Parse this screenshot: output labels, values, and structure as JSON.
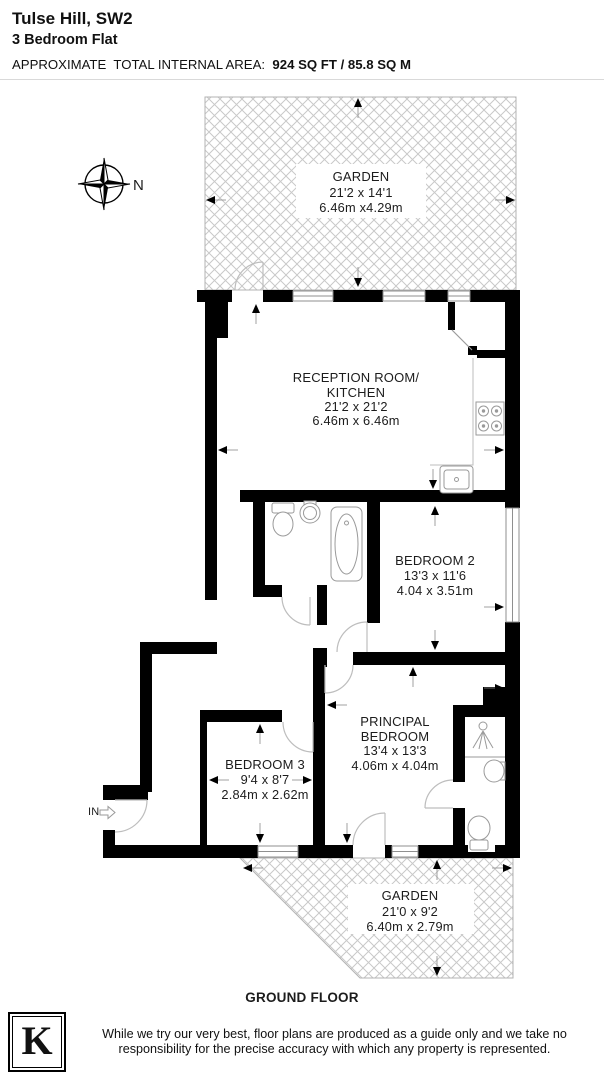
{
  "header": {
    "title": "Tulse Hill, SW2",
    "subtitle": "3 Bedroom Flat",
    "area_label": "APPROXIMATE  TOTAL INTERNAL AREA:  ",
    "area_value": "924 SQ FT / 85.8 SQ M"
  },
  "compass": {
    "label": "N"
  },
  "entrance": {
    "label": "IN"
  },
  "floor": {
    "label": "GROUND FLOOR"
  },
  "rooms": {
    "garden_top": {
      "name": "GARDEN",
      "size_ft": "21'2 x 14'1",
      "size_m": "6.46m x4.29m"
    },
    "reception": {
      "line1": "RECEPTION ROOM/",
      "line2": "KITCHEN",
      "size_ft": "21'2 x 21'2",
      "size_m": "6.46m x 6.46m"
    },
    "bedroom2": {
      "name": "BEDROOM 2",
      "size_ft": "13'3 x 11'6",
      "size_m": "4.04 x 3.51m"
    },
    "bedroom3": {
      "name": "BEDROOM 3",
      "size_ft": "9'4 x 8'7",
      "size_m": "2.84m x 2.62m"
    },
    "principal": {
      "line1": "PRINCIPAL",
      "line2": "BEDROOM",
      "size_ft": "13'4 x 13'3",
      "size_m": "4.06m x 4.04m"
    },
    "garden_bottom": {
      "name": "GARDEN",
      "size_ft": "21'0 x 9'2",
      "size_m": "6.40m x 2.79m"
    }
  },
  "footer": {
    "logo_letter": "K",
    "line1": "While we try our very best, floor plans are produced as a guide only and we take no",
    "line2": "responsibility for the precise accuracy with which any property is represented."
  },
  "colors": {
    "wall": "#000000",
    "hatch": "#c9c9c9",
    "garden_border": "#b3b3b3",
    "fixture": "#9a9a9a",
    "door_arc": "#c0c0c0",
    "text": "#1c1c1c"
  }
}
